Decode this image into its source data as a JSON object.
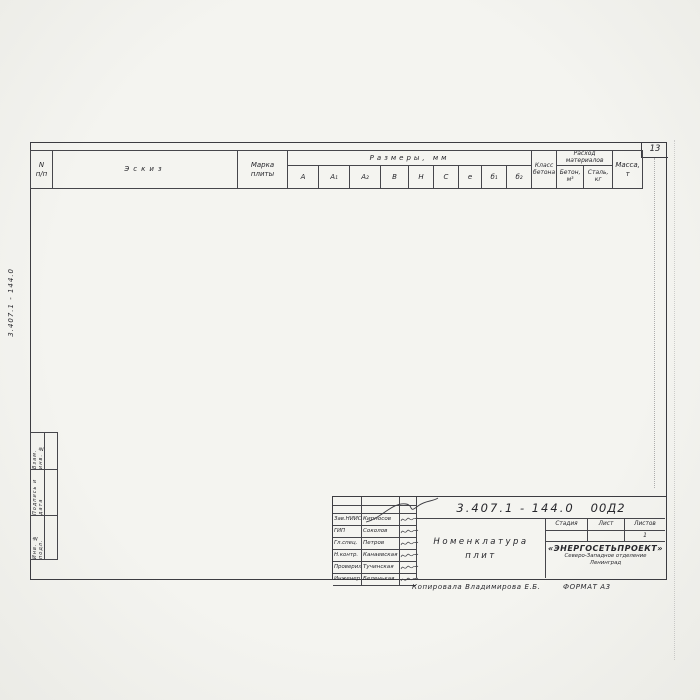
{
  "page": {
    "number": "13",
    "side_doc_number": "3.407.1 - 144.0",
    "copy_note": "Копировала  Владимирова Е.Б.",
    "format_note": "ФОРМАТ А3"
  },
  "margin_labels": [
    "Взам. инв. №",
    "Подпись и дата",
    "Инв. № подл."
  ],
  "table": {
    "headers": {
      "num_line1": "N",
      "num_line2": "п/п",
      "sketch": "Эскиз",
      "mark_line1": "Марка",
      "mark_line2": "плиты",
      "dims_group": "Размеры,  мм",
      "dims": [
        "А",
        "А₁",
        "А₂",
        "В",
        "Н",
        "С",
        "е",
        "б₁",
        "б₂"
      ],
      "class_line1": "Класс",
      "class_line2": "бетона",
      "materials_group": "Расход",
      "materials_group2": "материалов",
      "material_1a": "Бетон,",
      "material_1b": "м³",
      "material_2a": "Сталь,",
      "material_2b": "кг",
      "mass_line1": "Масса,",
      "mass_line2": "т"
    },
    "concrete_class_value": "В30",
    "rows": [
      {
        "n": "1",
        "mark": "П1,5×1",
        "a": "1000",
        "a1": "500",
        "a2": "500",
        "b": [
          "1500",
          3
        ],
        "h": [
          "400",
          3
        ],
        "c": [
          "800",
          3
        ],
        "e": [
          "610",
          3
        ],
        "b1": [
          "200",
          3
        ],
        "b2": "380",
        "concrete": "0,28",
        "steel": "41,1",
        "mass": "0,7"
      },
      {
        "n": "2",
        "mark": "П1,5×1,5",
        "a": "1500",
        "a1": "750",
        "a2": "750",
        "b2": "290",
        "concrete": "0,40",
        "steel": "48,1",
        "mass": "1,0"
      },
      {
        "n": "3",
        "mark": "П1,5×2,2",
        "a": "2200",
        "a1": "1100",
        "a2": "1100",
        "b2": "160",
        "concrete": "0,52",
        "steel": "68,9",
        "mass": "1,43"
      },
      {
        "n": "4",
        "mark": "П2×2,1",
        "a": "2100",
        "a1": "1050",
        "a2": "1050",
        "b": [
          "2000",
          3
        ],
        "h": [
          "500",
          3
        ],
        "c": [
          "1050",
          16
        ],
        "e": [
          "640",
          16
        ],
        "b1": [
          "400",
          1
        ],
        "b2": "400",
        "concrete": "0,84",
        "steel": "101,9",
        "mass": "2,1"
      },
      {
        "n": "5",
        "mark": "П2×2,8",
        "a": "2800",
        "a1": "1400",
        "a2": "1400",
        "b1": [
          "320",
          1
        ],
        "b2": "320",
        "concrete": "1,05",
        "steel": "123,8",
        "mass": "2,63"
      },
      {
        "n": "6",
        "mark": "П2×3,5",
        "a": "3500",
        "a1": "1750",
        "a2": "1750",
        "b1": [
          "250",
          1
        ],
        "b2": "250",
        "concrete": "1,37",
        "steel": "225,5",
        "mass": "3,42"
      },
      {
        "n": "7",
        "mark": "П2,7×3,5",
        "a": "3500",
        "a1": "1750",
        "a2": "1750",
        "b": [
          "2700",
          2
        ],
        "h": [
          "600",
          2
        ],
        "b1": [
          "370",
          1
        ],
        "b2": "370",
        "concrete": "2,0",
        "steel": "115,6",
        "mass": "5,0"
      },
      {
        "n": "8",
        "mark": "П2,7×4,5",
        "a": "4500",
        "a1": "2250",
        "a2": "2250",
        "b1": [
          "270",
          1
        ],
        "b2": "270",
        "concrete": "2,52",
        "steel": "155,4",
        "mass": "6,3"
      },
      {
        "n": "9",
        "mark": "П2×1,6-А",
        "a": "1600",
        "a1": "1050",
        "a2": "550",
        "b": [
          "2000",
          4
        ],
        "h": [
          "500",
          4
        ],
        "b1": [
          "400",
          1
        ],
        "b2": "500",
        "concrete": "0,66",
        "steel": "251,4",
        "mass": "1,65"
      },
      {
        "n": "10",
        "mark": "П2×2,3-А",
        "a": "2300",
        "a1": "1400",
        "a2": "900",
        "b1": [
          "325",
          1
        ],
        "b2": "430",
        "concrete": "0,96",
        "steel": "328,0",
        "mass": "2,4"
      },
      {
        "n": "11",
        "mark": "П2×3,0-А",
        "a": "3000",
        "a1": "1750",
        "a2": "1250",
        "b1": [
          "250",
          1
        ],
        "b2": "355",
        "concrete": "1,21",
        "steel": "263,4",
        "mass": "3,0"
      },
      {
        "n": "12",
        "mark": "П2×3,6-А",
        "a": "3600",
        "a1": "2050",
        "a2": "1550",
        "b1": [
          "190",
          1
        ],
        "b2": "300",
        "concrete": "1,43",
        "steel": "250,1",
        "mass": "3,55"
      },
      {
        "n": "13",
        "mark": "П2,7×2,7-А",
        "a": "2700",
        "a1": "1750",
        "a2": "950",
        "b": [
          "2700",
          4
        ],
        "h": [
          "600",
          4
        ],
        "b1": [
          "385",
          1
        ],
        "b2": "520",
        "concrete": "1,52",
        "steel": "298,8",
        "mass": "4,15"
      },
      {
        "n": "14",
        "mark": "П2,7×3,5-А",
        "a": "3500",
        "a1": "2000",
        "a2": "1500",
        "b1": [
          "320",
          1
        ],
        "b2": "415",
        "concrete": "2,1",
        "steel": "352,8",
        "mass": "5,25"
      },
      {
        "n": "15",
        "mark": "П2,7×4,2-А",
        "a": "4200",
        "a1": "2500",
        "a2": "1700",
        "b1": [
          "220",
          1
        ],
        "b2": "375",
        "concrete": "2,42",
        "steel": "387,3",
        "mass": "6,05"
      },
      {
        "n": "16",
        "mark": "П2,7×4,5-А",
        "a": "4500",
        "a1": "2500",
        "a2": "2000",
        "b1": [
          "220",
          1
        ],
        "b2": "320",
        "concrete": "2,5",
        "steel": "548,5",
        "mass": "6,5"
      },
      {
        "n": "17",
        "mark": "П2×3,5-А5",
        "a": "3500",
        "a1": "2050",
        "a2": "1550",
        "b": [
          "2000",
          1
        ],
        "h": [
          "500",
          1
        ],
        "b1": [
          "190",
          1
        ],
        "b2": "300",
        "concrete": "1,43",
        "steel": "460,3",
        "mass": "3,58"
      },
      {
        "n": "18",
        "mark": "П2,7×3,5-А5",
        "a": "3500",
        "a1": "2000",
        "a2": "1500",
        "b": [
          "2700",
          2
        ],
        "h": [
          "600",
          2
        ],
        "b1": [
          "320",
          1
        ],
        "b2": "415",
        "concrete": "2,1",
        "steel": "334,5",
        "mass": "5,25"
      },
      {
        "n": "19",
        "mark": "П2,7×4,5-А5",
        "a": "4500",
        "a1": "2500",
        "a2": "2000",
        "b1": [
          "220",
          1
        ],
        "b2": "320",
        "concrete": "2,6",
        "steel": "423,2",
        "mass": "8,5"
      }
    ]
  },
  "sketch": {
    "labels": {
      "top_width": "С",
      "top_inner": "е",
      "half_left": "А₁",
      "half_right": "А₂",
      "total": "А",
      "height": "Н",
      "t1": "б₁",
      "t2": "б₂",
      "side_width": "В",
      "edge": "100"
    }
  },
  "title_block": {
    "doc_number": "3.407.1 - 144.0",
    "doc_suffix": "00Д2",
    "title_line1": "Номенклатура",
    "title_line2": "плит",
    "stage_label": "Стадия",
    "sheet_label": "Лист",
    "sheets_label": "Листов",
    "stage_value": "",
    "sheet_value": "",
    "sheets_value": "1",
    "org_name": "«ЭНЕРГОСЕТЬПРОЕКТ»",
    "org_line2": "Северо-Западное отделение",
    "org_line3": "Ленинград",
    "signers": [
      {
        "role": "Зав.НИИС",
        "name": "Кирносов"
      },
      {
        "role": "ГИП",
        "name": "Соколов"
      },
      {
        "role": "Гл.спец.",
        "name": "Петров"
      },
      {
        "role": "Н.контр.",
        "name": "Канаевская"
      },
      {
        "role": "Проверил",
        "name": "Тучинская"
      },
      {
        "role": "Инженер",
        "name": "Беленькая"
      }
    ]
  }
}
